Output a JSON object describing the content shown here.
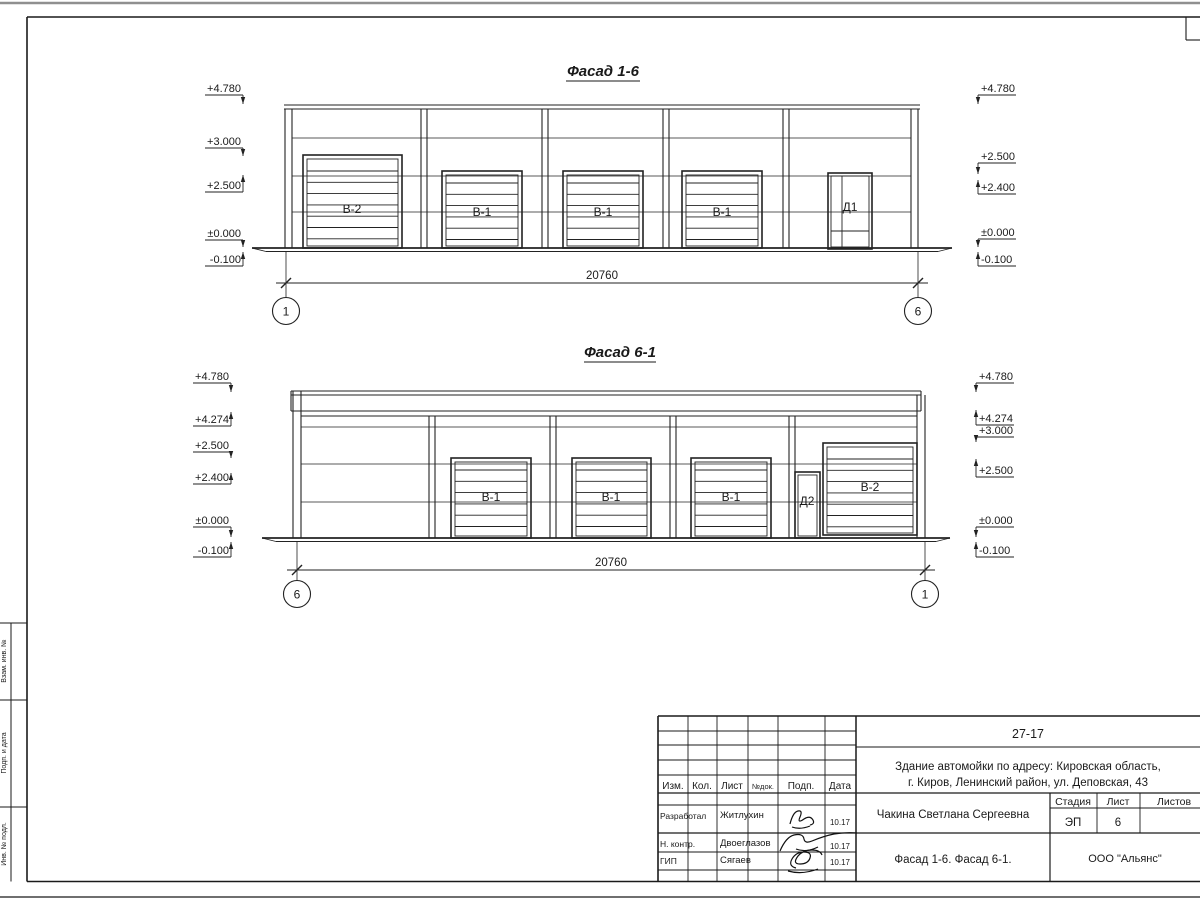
{
  "side_stamp": {
    "labels": [
      "Взам. инв. №",
      "Подп. и дата",
      "Инв. № подл."
    ]
  },
  "title_block": {
    "doc_number": "27-17",
    "address_line1": "Здание автомойки по адресу: Кировская область,",
    "address_line2": "г. Киров, Ленинский район, ул. Деповская, 43",
    "header_cols": {
      "izm": "Изм.",
      "kol": "Кол.",
      "list": "Лист",
      "ndok": "№док.",
      "podp": "Подп.",
      "data": "Дата"
    },
    "rows": [
      {
        "role": "Разработал",
        "name": "Житлухин",
        "date": "10.17"
      },
      {
        "role": "Н. контр.",
        "name": "Двоеглазов",
        "date": "10.17"
      },
      {
        "role": "ГИП",
        "name": "Сягаев",
        "date": "10.17"
      }
    ],
    "client": "Чакина Светлана Сергеевна",
    "stage_label": "Стадия",
    "sheet_label": "Лист",
    "sheets_label": "Листов",
    "stage": "ЭП",
    "sheet_no": "6",
    "sheets_total": "",
    "sheet_title": "Фасад 1-6. Фасад 6-1.",
    "company": "ООО \"Альянс\""
  },
  "facades": [
    {
      "title": "Фасад 1-6",
      "title_x": 603,
      "title_y": 76,
      "wall": {
        "x1": 285,
        "x2": 918,
        "top": 109,
        "base": 248
      },
      "cap": [
        {
          "y": 105,
          "x1": 284,
          "x2": 920
        },
        {
          "y": 109,
          "x1": 284,
          "x2": 920
        }
      ],
      "joints": [
        138,
        176,
        212
      ],
      "joint_x1": 292,
      "joint_x2": 911,
      "pilasters": [
        {
          "x": 285,
          "w": 7
        },
        {
          "x": 421,
          "w": 6
        },
        {
          "x": 542,
          "w": 6
        },
        {
          "x": 663,
          "w": 6
        },
        {
          "x": 783,
          "w": 6
        },
        {
          "x": 911,
          "w": 7
        }
      ],
      "gates": [
        {
          "kind": "roll",
          "label": "В-2",
          "x1": 303,
          "y1": 155,
          "x2": 402,
          "y2": 248,
          "lx": 352,
          "ly": 213,
          "slat_start": 16
        },
        {
          "kind": "roll",
          "label": "В-1",
          "x1": 442,
          "y1": 171,
          "x2": 522,
          "y2": 248,
          "lx": 482,
          "ly": 216,
          "slat_start": 12
        },
        {
          "kind": "roll",
          "label": "В-1",
          "x1": 563,
          "y1": 171,
          "x2": 643,
          "y2": 248,
          "lx": 603,
          "ly": 216,
          "slat_start": 12
        },
        {
          "kind": "roll",
          "label": "В-1",
          "x1": 682,
          "y1": 171,
          "x2": 762,
          "y2": 248,
          "lx": 722,
          "ly": 216,
          "slat_start": 12
        },
        {
          "kind": "door",
          "label": "Д1",
          "x1": 828,
          "y1": 173,
          "x2": 872,
          "y2": 249,
          "lx": 850,
          "ly": 211,
          "mullion": true
        }
      ],
      "ground": {
        "y": 248,
        "x1": 252,
        "x2": 952
      },
      "dim": {
        "y": 283,
        "x1": 286,
        "x2": 918,
        "label": "20760",
        "tx": 602,
        "ty": 279
      },
      "axes": [
        {
          "x": 286,
          "label": "1"
        },
        {
          "x": 918,
          "label": "6"
        }
      ],
      "axis_cy": 311,
      "marks_left": {
        "tx": 241,
        "bar": 243,
        "u1": 205,
        "items": [
          {
            "t": "+4.780",
            "line": 95,
            "tip": 104
          },
          {
            "t": "+3.000",
            "line": 148,
            "tip": 156
          },
          {
            "t": "+2.500",
            "line": 192,
            "tip": 175
          },
          {
            "t": "±0.000",
            "line": 240,
            "tip": 247
          },
          {
            "t": "-0.100",
            "line": 266,
            "tip": 252
          }
        ]
      },
      "marks_right": {
        "tx": 981,
        "bar": 978,
        "u2": 1016,
        "items": [
          {
            "t": "+4.780",
            "line": 95,
            "tip": 104
          },
          {
            "t": "+2.500",
            "line": 163,
            "tip": 174
          },
          {
            "t": "+2.400",
            "line": 194,
            "tip": 180
          },
          {
            "t": "±0.000",
            "line": 239,
            "tip": 247
          },
          {
            "t": "-0.100",
            "line": 266,
            "tip": 252
          }
        ]
      }
    },
    {
      "title": "Фасад 6-1",
      "title_x": 620,
      "title_y": 357,
      "wall": {
        "x1": 293,
        "x2": 925,
        "top": 416,
        "base": 538
      },
      "cap": [
        {
          "y": 391,
          "x1": 291,
          "x2": 921
        },
        {
          "y": 395,
          "x1": 291,
          "x2": 921
        },
        {
          "y": 411,
          "x1": 291,
          "x2": 921
        },
        {
          "y": 416,
          "x1": 301,
          "x2": 917
        }
      ],
      "band": {
        "x1": 291,
        "x2": 921,
        "y1": 391,
        "y2": 411
      },
      "joints": [
        427,
        464,
        502
      ],
      "joint_x1": 301,
      "joint_x2": 917,
      "pilasters": [
        {
          "x": 293,
          "w": 8,
          "top": 391
        },
        {
          "x": 429,
          "w": 6
        },
        {
          "x": 550,
          "w": 6
        },
        {
          "x": 670,
          "w": 6
        },
        {
          "x": 789,
          "w": 6
        },
        {
          "x": 917,
          "w": 8,
          "top": 395
        }
      ],
      "gates": [
        {
          "kind": "roll",
          "label": "В-1",
          "x1": 451,
          "y1": 458,
          "x2": 531,
          "y2": 538,
          "lx": 491,
          "ly": 501,
          "slat_start": 12
        },
        {
          "kind": "roll",
          "label": "В-1",
          "x1": 572,
          "y1": 458,
          "x2": 651,
          "y2": 538,
          "lx": 611,
          "ly": 501,
          "slat_start": 12
        },
        {
          "kind": "roll",
          "label": "В-1",
          "x1": 691,
          "y1": 458,
          "x2": 771,
          "y2": 538,
          "lx": 731,
          "ly": 501,
          "slat_start": 12
        },
        {
          "kind": "door",
          "label": "Д2",
          "x1": 795,
          "y1": 472,
          "x2": 820,
          "y2": 538,
          "lx": 807,
          "ly": 505,
          "mullion": false
        },
        {
          "kind": "roll",
          "label": "В-2",
          "x1": 823,
          "y1": 443,
          "x2": 917,
          "y2": 535,
          "lx": 870,
          "ly": 491,
          "slat_start": 16
        }
      ],
      "ground": {
        "y": 538,
        "x1": 262,
        "x2": 950
      },
      "dim": {
        "y": 570,
        "x1": 297,
        "x2": 925,
        "label": "20760",
        "tx": 611,
        "ty": 566
      },
      "axes": [
        {
          "x": 297,
          "label": "6"
        },
        {
          "x": 925,
          "label": "1"
        }
      ],
      "axis_cy": 594,
      "marks_left": {
        "tx": 229,
        "bar": 231,
        "u1": 193,
        "items": [
          {
            "t": "+4.780",
            "line": 383,
            "tip": 392
          },
          {
            "t": "+4.274",
            "line": 426,
            "tip": 412
          },
          {
            "t": "+2.500",
            "line": 452,
            "tip": 458
          },
          {
            "t": "+2.400",
            "line": 484,
            "tip": 473
          },
          {
            "t": "±0.000",
            "line": 527,
            "tip": 537
          },
          {
            "t": "-0.100",
            "line": 557,
            "tip": 542
          }
        ]
      },
      "marks_right": {
        "tx": 979,
        "bar": 976,
        "u2": 1014,
        "items": [
          {
            "t": "+4.780",
            "line": 383,
            "tip": 392
          },
          {
            "t": "+4.274",
            "line": 425,
            "tip": 410
          },
          {
            "t": "+3.000",
            "line": 437,
            "tip": 442
          },
          {
            "t": "+2.500",
            "line": 477,
            "tip": 459
          },
          {
            "t": "±0.000",
            "line": 527,
            "tip": 537
          },
          {
            "t": "-0.100",
            "line": 557,
            "tip": 542
          }
        ]
      }
    }
  ]
}
